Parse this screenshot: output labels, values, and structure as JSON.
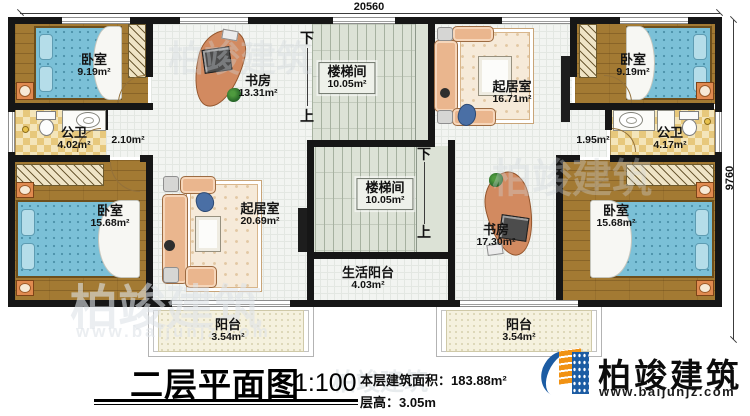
{
  "plan": {
    "dim_width": "20560",
    "dim_depth": "9760",
    "stair_down": "下",
    "stair_up": "上",
    "rooms": {
      "bedroom_tl": {
        "name": "卧室",
        "area": "9.19m²"
      },
      "bedroom_tr": {
        "name": "卧室",
        "area": "9.19m²"
      },
      "bedroom_bl": {
        "name": "卧室",
        "area": "15.68m²"
      },
      "bedroom_br": {
        "name": "卧室",
        "area": "15.68m²"
      },
      "bath_left": {
        "name": "公卫",
        "area": "4.02m²"
      },
      "bath_right": {
        "name": "公卫",
        "area": "4.17m²"
      },
      "hall_left": {
        "area": "2.10m²"
      },
      "hall_right": {
        "area": "1.95m²"
      },
      "study_top": {
        "name": "书房",
        "area": "13.31m²"
      },
      "study_bottom": {
        "name": "书房",
        "area": "17.30m²"
      },
      "stair_top": {
        "name": "楼梯间",
        "area": "10.05m²"
      },
      "stair_bottom": {
        "name": "楼梯间",
        "area": "10.05m²"
      },
      "living_top": {
        "name": "起居室",
        "area": "16.71m²"
      },
      "living_bottom": {
        "name": "起居室",
        "area": "20.69m²"
      },
      "service_balcony": {
        "name": "生活阳台",
        "area": "4.03m²"
      },
      "balcony_left": {
        "name": "阳台",
        "area": "3.54m²"
      },
      "balcony_right": {
        "name": "阳台",
        "area": "3.54m²"
      }
    }
  },
  "titleblock": {
    "title": "二层平面图",
    "scale": "1:100",
    "area_label": "本层建筑面积：",
    "area_value": "183.88m²",
    "floor_height_label": "层高：",
    "floor_height_value": "3.05m"
  },
  "logo": {
    "name": "柏竣建筑",
    "url": "www.baijunjz.com"
  },
  "watermark": {
    "name": "柏竣建筑",
    "url": "www.baijunjz.com"
  }
}
